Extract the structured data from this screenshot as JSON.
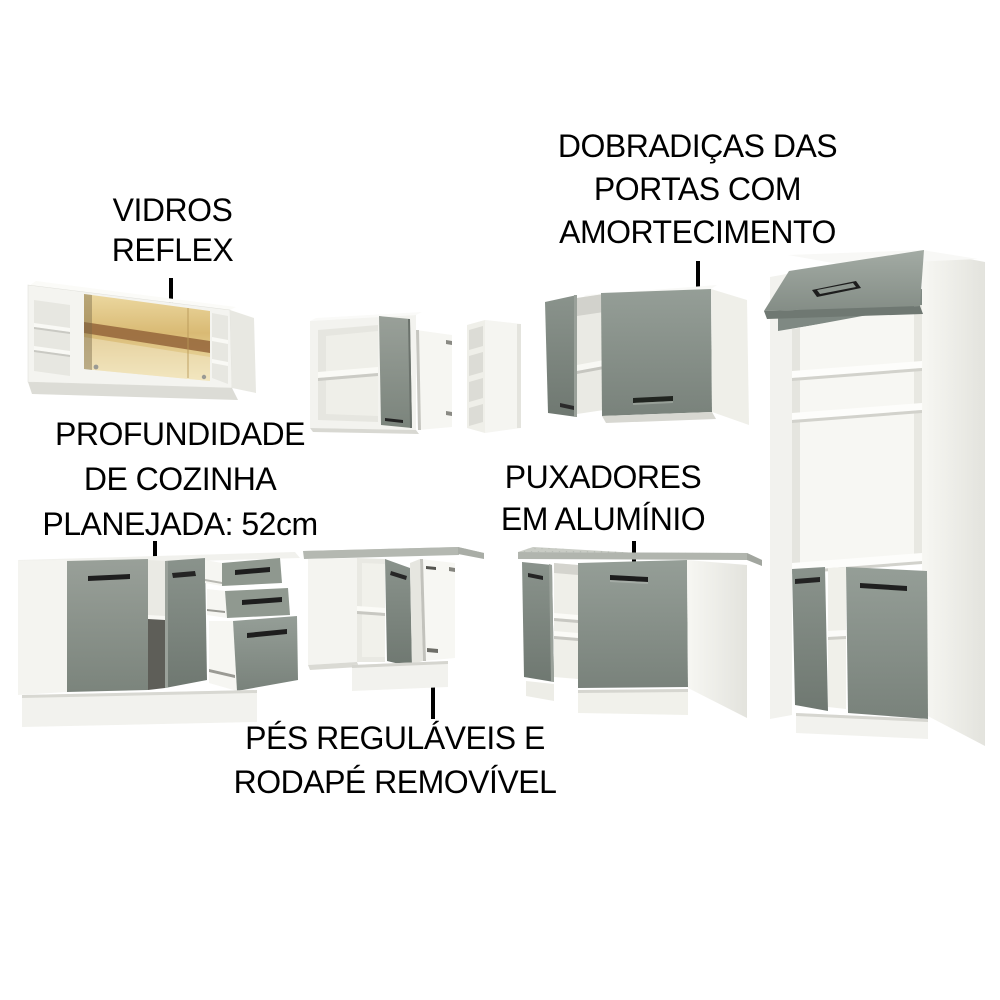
{
  "annotations": [
    {
      "id": "vidros-reflex",
      "lines": [
        "VIDROS",
        "REFLEX"
      ]
    },
    {
      "id": "dobradicas",
      "lines": [
        "DOBRADIÇAS DAS",
        "PORTAS COM",
        "AMORTECIMENTO"
      ]
    },
    {
      "id": "profundidade",
      "lines": [
        "PROFUNDIDADE",
        "DE COZINHA",
        "PLANEJADA: 52cm"
      ]
    },
    {
      "id": "puxadores",
      "lines": [
        "PUXADORES",
        "EM ALUMÍNIO"
      ]
    },
    {
      "id": "pes-rodape",
      "lines": [
        "PÉS REGULÁVEIS E",
        "RODAPÉ REMOVÍVEL"
      ]
    }
  ],
  "colors": {
    "background": "#ffffff",
    "text": "#000000",
    "callout_line": "#000000",
    "cabinet_door_grey": "#8a908a",
    "cabinet_body_white": "#f4f4f0",
    "countertop_grey": "#c6c9c2",
    "glass_gold": "#dcbe7a",
    "glass_band_brown": "#96683c",
    "handle_black": "#1e1e1e"
  },
  "figures": [
    {
      "id": "glass-wall-cabinet",
      "label": "wall cabinet with reflex glass"
    },
    {
      "id": "corner-wall-cabinet",
      "label": "corner wall cabinet, open grey door"
    },
    {
      "id": "open-shelf-unit",
      "label": "narrow open shelf end unit"
    },
    {
      "id": "double-door-wall-cabinet",
      "label": "two-door wall cabinet, one door open"
    },
    {
      "id": "tall-oven-cabinet",
      "label": "tall oven tower with flip-up door"
    },
    {
      "id": "drawer-base-cabinet",
      "label": "base cabinet with three open drawers"
    },
    {
      "id": "corner-base-cabinet",
      "label": "corner base cabinet with countertop"
    },
    {
      "id": "door-base-cabinet",
      "label": "double-door base cabinet with countertop"
    }
  ]
}
